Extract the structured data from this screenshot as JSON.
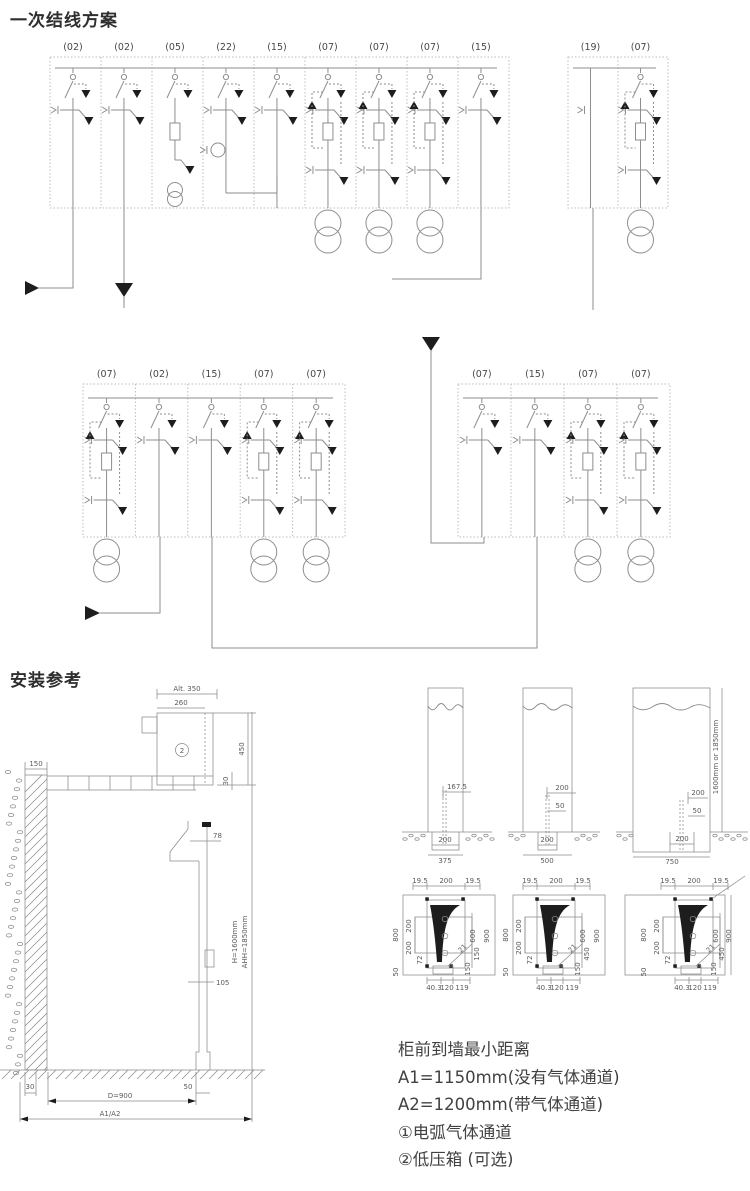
{
  "sections": {
    "scheme_title": "一次结线方案",
    "install_title": "安装参考"
  },
  "schemes": {
    "rows": [
      {
        "groups": [
          {
            "cells": [
              {
                "label": "(02)",
                "kind": "feeder"
              },
              {
                "label": "(02)",
                "kind": "feeder"
              },
              {
                "label": "(05)",
                "kind": "pt"
              },
              {
                "label": "(22)",
                "kind": "meter"
              },
              {
                "label": "(15)",
                "kind": "switch"
              },
              {
                "label": "(07)",
                "kind": "tx"
              },
              {
                "label": "(07)",
                "kind": "tx"
              },
              {
                "label": "(07)",
                "kind": "tx"
              },
              {
                "label": "(15)",
                "kind": "switch"
              }
            ]
          },
          {
            "cells": [
              {
                "label": "(19)",
                "kind": "riser"
              },
              {
                "label": "(07)",
                "kind": "tx"
              }
            ]
          }
        ]
      },
      {
        "groups": [
          {
            "cells": [
              {
                "label": "(07)",
                "kind": "tx"
              },
              {
                "label": "(02)",
                "kind": "feeder"
              },
              {
                "label": "(15)",
                "kind": "switch"
              },
              {
                "label": "(07)",
                "kind": "tx"
              },
              {
                "label": "(07)",
                "kind": "tx"
              }
            ]
          },
          {
            "cells": [
              {
                "label": "(07)",
                "kind": "feeder"
              },
              {
                "label": "(15)",
                "kind": "switch"
              },
              {
                "label": "(07)",
                "kind": "tx"
              },
              {
                "label": "(07)",
                "kind": "tx"
              }
            ]
          }
        ]
      }
    ]
  },
  "install": {
    "left_view": {
      "top_dims": {
        "alt": "Alt. 350",
        "w260": "260",
        "v450": "450",
        "v30": "30",
        "wall": "150"
      },
      "body_dims": {
        "d78": "78",
        "d105": "105"
      },
      "height_note": [
        "H=1600mm",
        "AHH=1850mm"
      ],
      "low_voltage_box_mark": "2",
      "bottom_dims": {
        "b30": "30",
        "d900": "D=900",
        "b50": "50",
        "a": "A1/A2"
      }
    },
    "front_views": [
      {
        "upper_dims": [
          "167.5"
        ],
        "trench_width": "200",
        "cabinet_width": "375"
      },
      {
        "upper_dims": [
          "200",
          "50"
        ],
        "trench_width": "200",
        "cabinet_width": "500"
      },
      {
        "upper_dims": [
          "200",
          "50"
        ],
        "trench_width": "200",
        "cabinet_width": "750",
        "side_note": "1600mm or 1850mm"
      }
    ],
    "plan_views": [
      {
        "top": [
          "19.5",
          "200",
          "19.5"
        ],
        "left": [
          "800",
          "200",
          "200",
          "72",
          "50"
        ],
        "right": [
          "600",
          "900",
          "150",
          "150"
        ],
        "bottom": [
          "40.3",
          "120",
          "119"
        ],
        "diag": "21"
      },
      {
        "top": [
          "19.5",
          "200",
          "19.5"
        ],
        "left": [
          "800",
          "200",
          "200",
          "72",
          "50"
        ],
        "right": [
          "600",
          "900",
          "450",
          "150"
        ],
        "bottom": [
          "40.3",
          "120",
          "119"
        ],
        "diag": "21"
      },
      {
        "top": [
          "19.5",
          "200",
          "19.5"
        ],
        "left": [
          "800",
          "200",
          "200",
          "72",
          "50"
        ],
        "right": [
          "600",
          "900",
          "450",
          "150"
        ],
        "bottom": [
          "40.3",
          "120",
          "119"
        ],
        "diag": "21"
      }
    ]
  },
  "notes": {
    "lines": [
      "柜前到墙最小距离",
      "A1=1150mm(没有气体通道)",
      "A2=1200mm(带气体通道)",
      "①电弧气体通道",
      "②低压箱 (可选)"
    ]
  }
}
